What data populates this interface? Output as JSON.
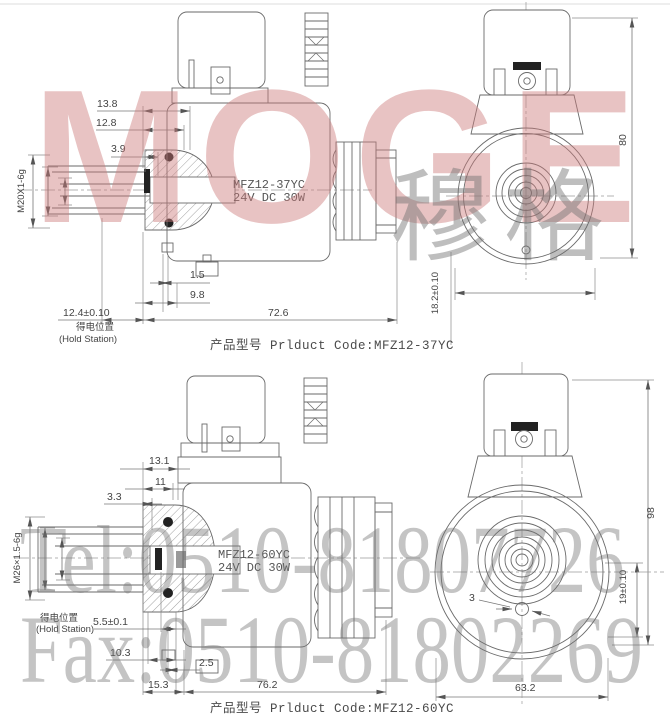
{
  "watermarks": {
    "brand": "MOGE",
    "brand_cn": "穆格",
    "tel": "Tel:0510-81807726",
    "fax": "Fax:0510-81802269"
  },
  "top": {
    "model_line1": "MFZ12-37YC",
    "model_line2": "24V DC 30W",
    "caption": "产品型号 Prlduct Code:MFZ12-37YC",
    "dims": {
      "width_a": "13.8",
      "width_b": "12.8",
      "width_c": "3.9",
      "thread": "M20X1-6g",
      "gap": "1.5",
      "depth": "9.8",
      "hold_dim": "12.4±0.10",
      "hold_cn": "得电位置",
      "hold_en": "(Hold Station)",
      "total_len": "72.6",
      "height": "80",
      "offset": "18.2±0.10"
    }
  },
  "bottom": {
    "model_line1": "MFZ12-60YC",
    "model_line2": "24V DC 30W",
    "caption": "产品型号 Prlduct Code:MFZ12-60YC",
    "dims": {
      "width_a": "13.1",
      "width_b": "11",
      "width_c": "3.3",
      "thread": "M26×1.5-6g",
      "hold_cn": "得电位置",
      "hold_en": "(Hold Station)",
      "hold_dim": "5.5±0.1",
      "depth_a": "10.3",
      "gap": "2.5",
      "offset_a": "15.3",
      "total_len": "76.2",
      "pin": "3",
      "width": "63.2",
      "offset_b": "19±0.10",
      "height": "98"
    }
  }
}
